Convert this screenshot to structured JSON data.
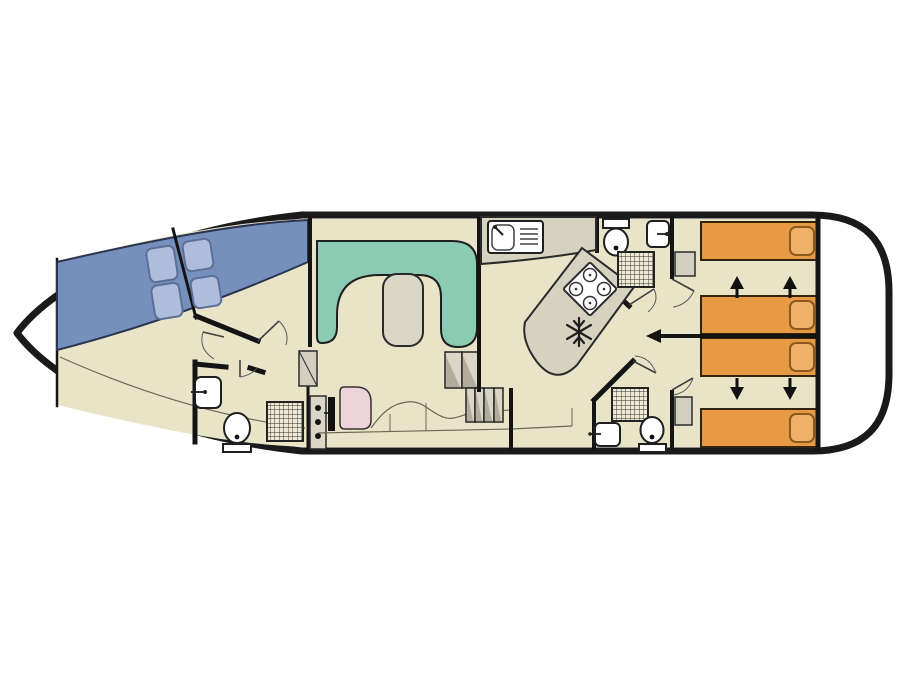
{
  "title": "Houseboat deck plan (top view)",
  "canvas": {
    "width": 901,
    "height": 676,
    "background_hex": "#ffffff"
  },
  "colors": {
    "hull_fill": "#ffffff",
    "hull_line": "#1a1a1a",
    "floor": "#e9e4c8",
    "front_bed_blue": "#7590bd",
    "front_pillow_blue": "#aebddb",
    "sofa_green": "#8bcab3",
    "table_beige": "#dbd7c5",
    "counter_grey": "#d6d2c0",
    "aft_bed_orange": "#e79a43",
    "aft_pillow_orange": "#efb168",
    "seat_pink": "#eed3da",
    "wardrobe_grey": "#d2cfc0",
    "steps_grey": "#d9d6c6",
    "fixture_white": "#ffffff",
    "ink": "#1f1f1f"
  },
  "regions": [
    "bow-locker",
    "front-cabin-port",
    "front-cabin-starboard",
    "front-bathroom",
    "saloon",
    "galley",
    "aft-bathroom-top",
    "aft-bathroom-bottom",
    "aft-cabin-top",
    "aft-cabin-bottom",
    "stern-deck"
  ],
  "fixtures": {
    "double_beds_front": 2,
    "single_beds_aft": 4,
    "pillows": 8,
    "u_sofa": 1,
    "saloon_table": 1,
    "helm_seat": 1,
    "galley_sink": 1,
    "stove_burners": 4,
    "fridge": 1,
    "toilets": 3,
    "washbasins": 4,
    "showers": 3,
    "wardrobes": 3,
    "step_flights": 2
  },
  "annotations": {
    "bed_slide_arrows": 4,
    "partition_slide_arrow": 1
  }
}
